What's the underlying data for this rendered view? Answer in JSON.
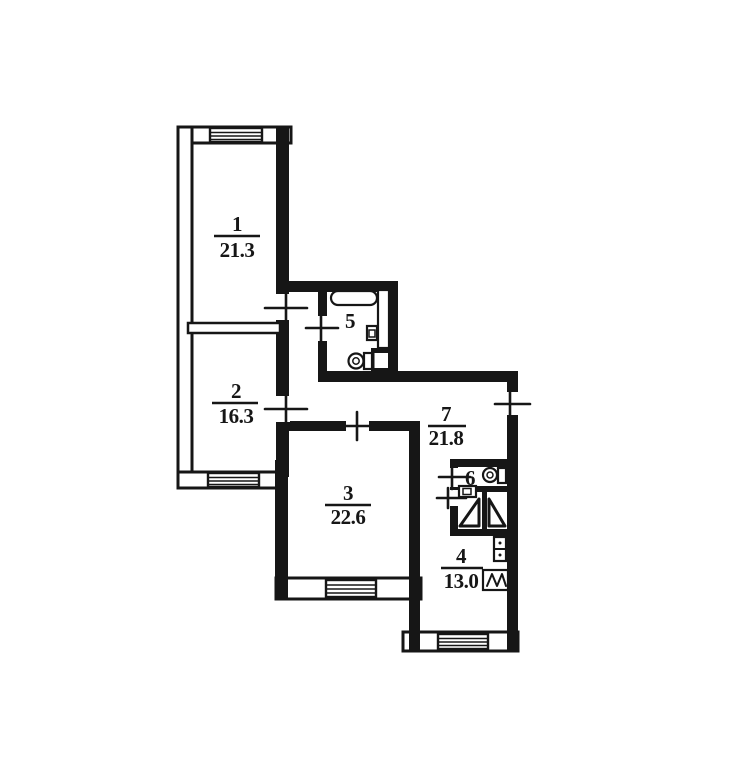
{
  "document": {
    "kind": "apartment-floor-plan",
    "style": "scanned BTI technical plan, black ink on white"
  },
  "colors": {
    "wall": "#161616",
    "background": "#ffffff"
  },
  "rooms": [
    {
      "number": "1",
      "area": "21.3"
    },
    {
      "number": "2",
      "area": "16.3"
    },
    {
      "number": "3",
      "area": "22.6"
    },
    {
      "number": "4",
      "area": "13.0"
    },
    {
      "number": "5"
    },
    {
      "number": "6"
    },
    {
      "number": "7",
      "area": "21.8"
    }
  ]
}
